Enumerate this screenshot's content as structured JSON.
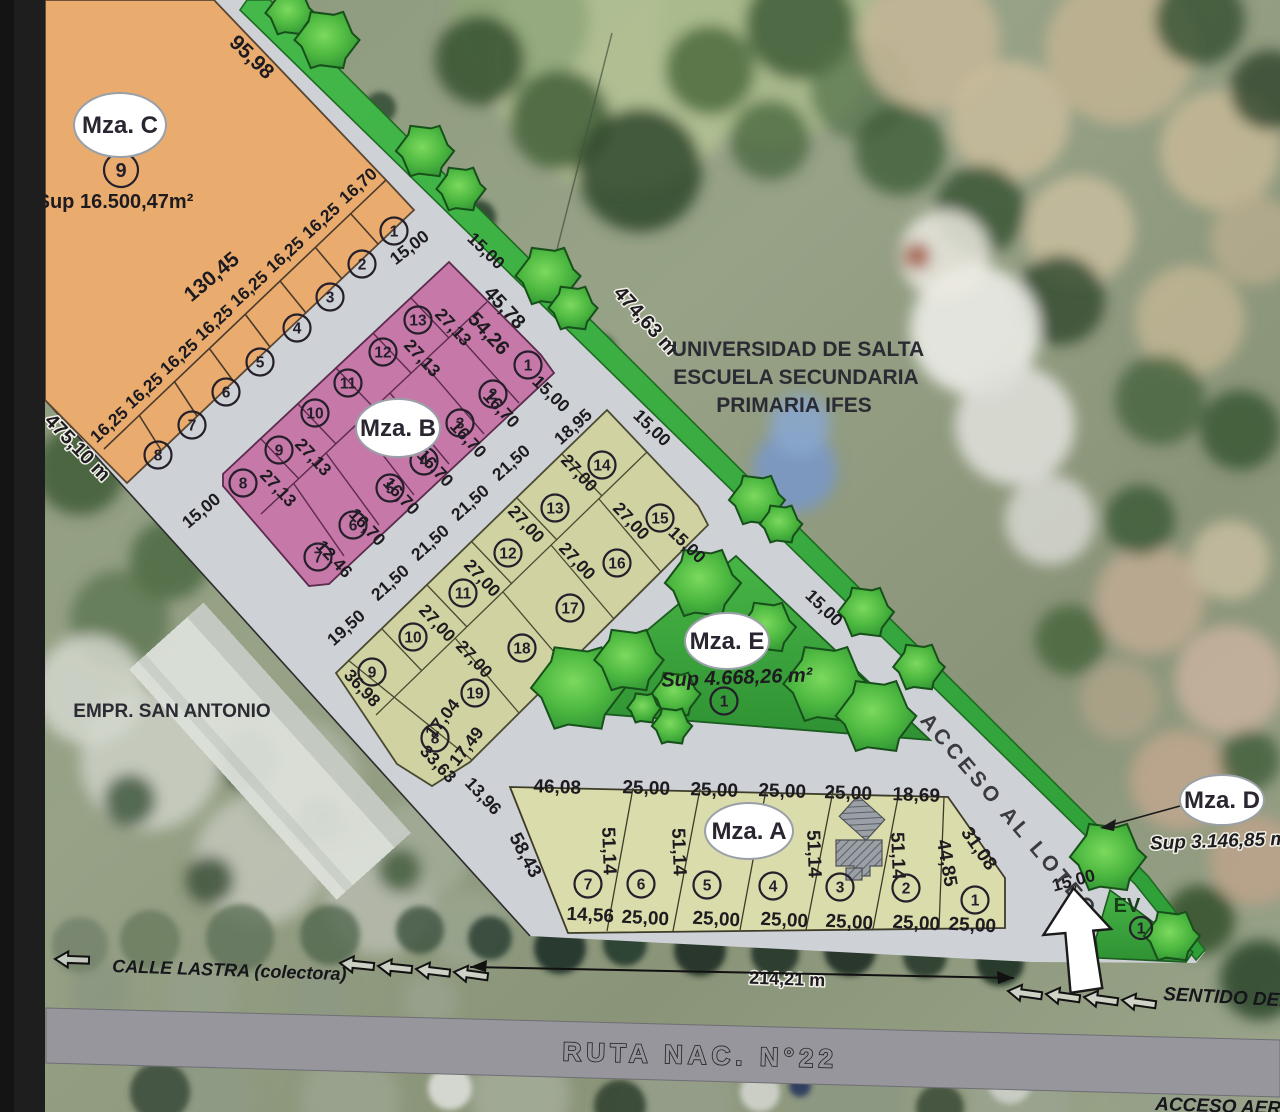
{
  "map": {
    "region_labels": {
      "universidad_line1": "UNIVERSIDAD DE SALTA",
      "universidad_line2": "ESCUELA SECUNDARIA",
      "universidad_line3": "PRIMARIA IFES",
      "empresa": "EMPR. SAN ANTONIO"
    },
    "roads": {
      "ruta": "RUTA NAC. N°22",
      "calle": "CALLE LASTRA (colectora)",
      "acceso": "ACCESO AL LOTEO",
      "sentido": "SENTIDO DEL",
      "acceso_aeropuerto": "ACCESO AEROPU",
      "ev": "EV"
    },
    "blocks": {
      "mza_c": {
        "label": "Mza. C",
        "sup": "Sup 16.500,47m²"
      },
      "mza_b": {
        "label": "Mza. B"
      },
      "mza_e": {
        "label": "Mza. E",
        "sup": "Sup 4.668,26 m²"
      },
      "mza_a": {
        "label": "Mza. A"
      },
      "mza_d": {
        "label": "Mza. D",
        "sup": "Sup 3.146,85 m²"
      }
    },
    "colors": {
      "block_c_orange": "#e9ac6e",
      "block_b_pink": "#c678a8",
      "block_olive": "#d0d2a2",
      "block_a_yellow": "#dadcab",
      "green_space": "#3cb043",
      "street_gray": "#ced1d5",
      "ruta_gray": "#96969c"
    },
    "dim_labels": [
      {
        "t": "95,98",
        "x": 247,
        "y": 62,
        "r": 44,
        "s": 21
      },
      {
        "t": "130,45",
        "x": 216,
        "y": 282,
        "r": -40,
        "s": 21
      },
      {
        "t": "16,70",
        "x": 362,
        "y": 190,
        "r": -42
      },
      {
        "t": "16,25",
        "x": 325,
        "y": 225,
        "r": -42
      },
      {
        "t": "16,25",
        "x": 289,
        "y": 259,
        "r": -42
      },
      {
        "t": "16,25",
        "x": 253,
        "y": 293,
        "r": -42
      },
      {
        "t": "16,25",
        "x": 218,
        "y": 327,
        "r": -42
      },
      {
        "t": "16,25",
        "x": 183,
        "y": 361,
        "r": -42
      },
      {
        "t": "16,25",
        "x": 148,
        "y": 395,
        "r": -42
      },
      {
        "t": "16,25",
        "x": 113,
        "y": 429,
        "r": -42
      },
      {
        "t": "475,10 m",
        "x": 73,
        "y": 452,
        "r": 46,
        "s": 20,
        "h": 1
      },
      {
        "t": "474,63 m",
        "x": 641,
        "y": 325,
        "r": 48,
        "s": 20,
        "h": 1
      },
      {
        "t": "15,00",
        "x": 205,
        "y": 515,
        "r": -40
      },
      {
        "t": "15,00",
        "x": 413,
        "y": 252,
        "r": -38
      },
      {
        "t": "15,00",
        "x": 482,
        "y": 255,
        "r": 44
      },
      {
        "t": "15,00",
        "x": 547,
        "y": 398,
        "r": 44
      },
      {
        "t": "15,00",
        "x": 648,
        "y": 432,
        "r": 44
      },
      {
        "t": "15,00",
        "x": 683,
        "y": 549,
        "r": 44
      },
      {
        "t": "15,00",
        "x": 820,
        "y": 612,
        "r": 44
      },
      {
        "t": "15,00",
        "x": 1075,
        "y": 886,
        "r": -15
      },
      {
        "t": "45,78",
        "x": 500,
        "y": 312,
        "r": 47,
        "s": 20
      },
      {
        "t": "54,26",
        "x": 484,
        "y": 338,
        "r": 47,
        "s": 20
      },
      {
        "t": "27,13",
        "x": 449,
        "y": 331,
        "r": 47
      },
      {
        "t": "27,13",
        "x": 418,
        "y": 362,
        "r": 47
      },
      {
        "t": "27,13",
        "x": 309,
        "y": 461,
        "r": 47
      },
      {
        "t": "27,13",
        "x": 274,
        "y": 492,
        "r": 47
      },
      {
        "t": "16,70",
        "x": 497,
        "y": 413,
        "r": 47
      },
      {
        "t": "16,70",
        "x": 464,
        "y": 443,
        "r": 47
      },
      {
        "t": "16,70",
        "x": 431,
        "y": 472,
        "r": 47
      },
      {
        "t": "16,70",
        "x": 397,
        "y": 500,
        "r": 47
      },
      {
        "t": "16,70",
        "x": 363,
        "y": 531,
        "r": 47
      },
      {
        "t": "12,46",
        "x": 330,
        "y": 563,
        "r": 47
      },
      {
        "t": "18,95",
        "x": 577,
        "y": 431,
        "r": -42
      },
      {
        "t": "21,50",
        "x": 515,
        "y": 467,
        "r": -42
      },
      {
        "t": "21,50",
        "x": 474,
        "y": 507,
        "r": -42
      },
      {
        "t": "21,50",
        "x": 434,
        "y": 547,
        "r": -42
      },
      {
        "t": "21,50",
        "x": 394,
        "y": 587,
        "r": -42
      },
      {
        "t": "19,50",
        "x": 350,
        "y": 632,
        "r": -42
      },
      {
        "t": "36,98",
        "x": 358,
        "y": 692,
        "r": 47
      },
      {
        "t": "27,00",
        "x": 575,
        "y": 477,
        "r": 47
      },
      {
        "t": "27,00",
        "x": 627,
        "y": 525,
        "r": 47
      },
      {
        "t": "27,00",
        "x": 522,
        "y": 528,
        "r": 47
      },
      {
        "t": "27,00",
        "x": 573,
        "y": 565,
        "r": 47
      },
      {
        "t": "27,00",
        "x": 478,
        "y": 582,
        "r": 47
      },
      {
        "t": "27,00",
        "x": 433,
        "y": 627,
        "r": 47
      },
      {
        "t": "27,00",
        "x": 470,
        "y": 663,
        "r": 47
      },
      {
        "t": "17,04",
        "x": 447,
        "y": 722,
        "r": -52
      },
      {
        "t": "17,49",
        "x": 471,
        "y": 750,
        "r": -52
      },
      {
        "t": "33,63",
        "x": 434,
        "y": 768,
        "r": 47
      },
      {
        "t": "13,96",
        "x": 479,
        "y": 800,
        "r": 47
      },
      {
        "t": "46,08",
        "x": 557,
        "y": 793,
        "r": 2,
        "s": 19
      },
      {
        "t": "25,00",
        "x": 646,
        "y": 794,
        "r": 2,
        "s": 19
      },
      {
        "t": "25,00",
        "x": 714,
        "y": 796,
        "r": 2,
        "s": 19
      },
      {
        "t": "25,00",
        "x": 782,
        "y": 797,
        "r": 2,
        "s": 19
      },
      {
        "t": "25,00",
        "x": 848,
        "y": 799,
        "r": 2,
        "s": 19
      },
      {
        "t": "18,69",
        "x": 916,
        "y": 801,
        "r": 2,
        "s": 19
      },
      {
        "t": "14,56",
        "x": 590,
        "y": 921,
        "r": 3,
        "s": 19
      },
      {
        "t": "25,00",
        "x": 645,
        "y": 924,
        "r": 3,
        "s": 19
      },
      {
        "t": "25,00",
        "x": 716,
        "y": 925,
        "r": 3,
        "s": 19
      },
      {
        "t": "25,00",
        "x": 784,
        "y": 926,
        "r": 3,
        "s": 19
      },
      {
        "t": "25,00",
        "x": 849,
        "y": 928,
        "r": 3,
        "s": 19
      },
      {
        "t": "25,00",
        "x": 916,
        "y": 929,
        "r": 3,
        "s": 19
      },
      {
        "t": "25,00",
        "x": 972,
        "y": 931,
        "r": 3,
        "s": 19
      },
      {
        "t": "58,43",
        "x": 520,
        "y": 858,
        "r": 62,
        "s": 19
      },
      {
        "t": "51,14",
        "x": 603,
        "y": 851,
        "r": 88,
        "s": 19
      },
      {
        "t": "51,14",
        "x": 673,
        "y": 852,
        "r": 88,
        "s": 19
      },
      {
        "t": "51,14",
        "x": 808,
        "y": 854,
        "r": 88,
        "s": 19
      },
      {
        "t": "51,14",
        "x": 892,
        "y": 856,
        "r": 88,
        "s": 19
      },
      {
        "t": "44,85",
        "x": 941,
        "y": 864,
        "r": 80,
        "s": 19
      },
      {
        "t": "31,08",
        "x": 974,
        "y": 852,
        "r": 55,
        "s": 19
      },
      {
        "t": "214,21 m",
        "x": 787,
        "y": 985,
        "r": 2,
        "s": 18,
        "h": 1
      }
    ],
    "lot_markers": [
      {
        "n": "9",
        "x": 121,
        "y": 170,
        "big": 1
      },
      {
        "n": "1",
        "x": 394,
        "y": 231
      },
      {
        "n": "2",
        "x": 362,
        "y": 264
      },
      {
        "n": "3",
        "x": 330,
        "y": 297
      },
      {
        "n": "4",
        "x": 297,
        "y": 328
      },
      {
        "n": "5",
        "x": 260,
        "y": 362
      },
      {
        "n": "6",
        "x": 226,
        "y": 392
      },
      {
        "n": "7",
        "x": 192,
        "y": 425
      },
      {
        "n": "8",
        "x": 158,
        "y": 455
      },
      {
        "n": "1",
        "x": 528,
        "y": 365
      },
      {
        "n": "2",
        "x": 493,
        "y": 394
      },
      {
        "n": "3",
        "x": 460,
        "y": 423
      },
      {
        "n": "4",
        "x": 424,
        "y": 461
      },
      {
        "n": "5",
        "x": 390,
        "y": 488
      },
      {
        "n": "6",
        "x": 353,
        "y": 525
      },
      {
        "n": "7",
        "x": 318,
        "y": 557
      },
      {
        "n": "8",
        "x": 243,
        "y": 483
      },
      {
        "n": "9",
        "x": 279,
        "y": 450
      },
      {
        "n": "10",
        "x": 315,
        "y": 413
      },
      {
        "n": "11",
        "x": 348,
        "y": 383
      },
      {
        "n": "12",
        "x": 383,
        "y": 352
      },
      {
        "n": "13",
        "x": 418,
        "y": 320
      },
      {
        "n": "8",
        "x": 435,
        "y": 738
      },
      {
        "n": "9",
        "x": 372,
        "y": 672
      },
      {
        "n": "10",
        "x": 413,
        "y": 637
      },
      {
        "n": "11",
        "x": 463,
        "y": 593
      },
      {
        "n": "12",
        "x": 508,
        "y": 553
      },
      {
        "n": "13",
        "x": 555,
        "y": 508
      },
      {
        "n": "14",
        "x": 602,
        "y": 465
      },
      {
        "n": "15",
        "x": 660,
        "y": 518
      },
      {
        "n": "16",
        "x": 617,
        "y": 563
      },
      {
        "n": "17",
        "x": 570,
        "y": 608
      },
      {
        "n": "18",
        "x": 522,
        "y": 648
      },
      {
        "n": "19",
        "x": 475,
        "y": 693
      },
      {
        "n": "1",
        "x": 724,
        "y": 701
      },
      {
        "n": "7",
        "x": 588,
        "y": 884
      },
      {
        "n": "6",
        "x": 641,
        "y": 884
      },
      {
        "n": "5",
        "x": 707,
        "y": 885
      },
      {
        "n": "4",
        "x": 773,
        "y": 886
      },
      {
        "n": "3",
        "x": 840,
        "y": 887
      },
      {
        "n": "2",
        "x": 906,
        "y": 888
      },
      {
        "n": "1",
        "x": 975,
        "y": 900
      },
      {
        "n": "1",
        "x": 1141,
        "y": 928,
        "sm": 1
      }
    ],
    "trees": [
      [
        290,
        13,
        22
      ],
      [
        327,
        40,
        29
      ],
      [
        425,
        151,
        26
      ],
      [
        461,
        189,
        22
      ],
      [
        548,
        276,
        29
      ],
      [
        573,
        308,
        22
      ],
      [
        703,
        583,
        34
      ],
      [
        757,
        500,
        25
      ],
      [
        781,
        524,
        19
      ],
      [
        866,
        612,
        25
      ],
      [
        919,
        667,
        23
      ],
      [
        1108,
        857,
        34
      ],
      [
        1172,
        936,
        25
      ],
      [
        578,
        688,
        42
      ],
      [
        629,
        660,
        31
      ],
      [
        676,
        694,
        22
      ],
      [
        672,
        726,
        18
      ],
      [
        644,
        708,
        15
      ],
      [
        768,
        627,
        25
      ],
      [
        826,
        684,
        38
      ],
      [
        876,
        716,
        36
      ]
    ]
  }
}
